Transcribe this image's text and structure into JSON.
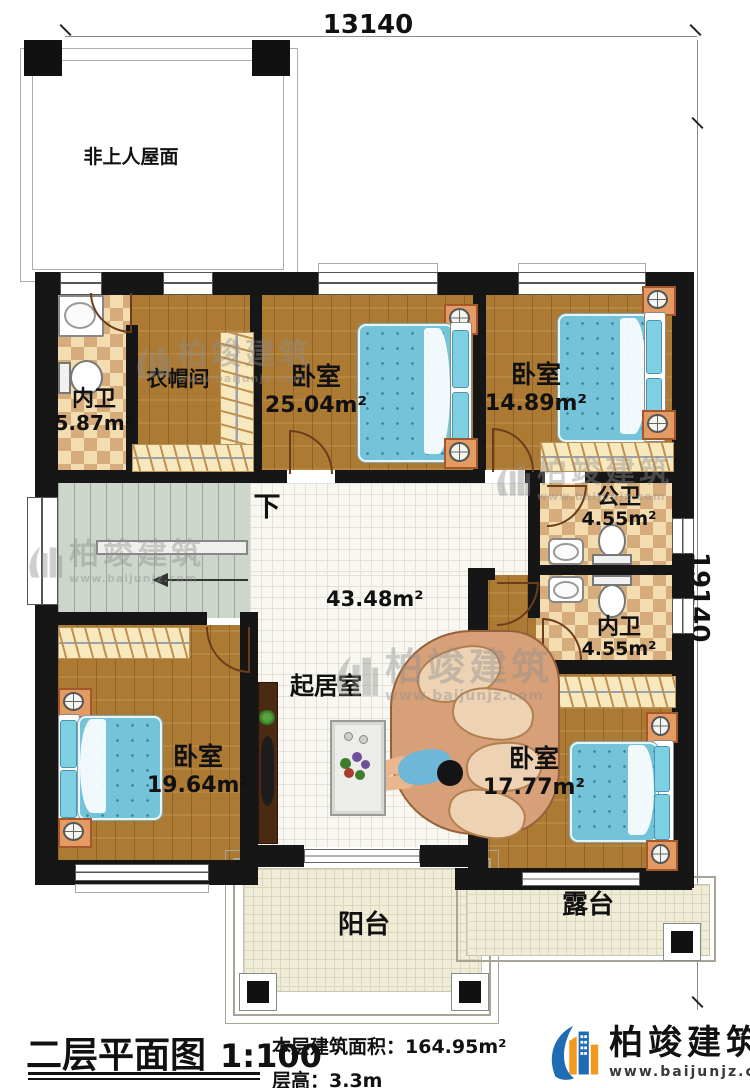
{
  "dimensions": {
    "top": "13140",
    "right": "19140"
  },
  "roof": {
    "label": "非上人屋面"
  },
  "stairs": {
    "down_label": "下"
  },
  "rooms": {
    "bath_top": {
      "name": "内卫",
      "area": "5.87m²"
    },
    "cloakroom": {
      "name": "衣帽间"
    },
    "bedroom_top_mid": {
      "name": "卧室",
      "area": "25.04m²"
    },
    "bedroom_top_right": {
      "name": "卧室",
      "area": "14.89m²"
    },
    "bath_public": {
      "name": "公卫",
      "area": "4.55m²"
    },
    "bath_ensuite": {
      "name": "内卫",
      "area": "4.55m²"
    },
    "living": {
      "name": "起居室",
      "area": "43.48m²"
    },
    "bedroom_bottom_left": {
      "name": "卧室",
      "area": "19.64m²"
    },
    "bedroom_bottom_right": {
      "name": "卧室",
      "area": "17.77m²"
    },
    "balcony": {
      "name": "阳台"
    },
    "terrace": {
      "name": "露台"
    }
  },
  "title_block": {
    "drawing_title": "二层平面图",
    "scale": "1:100",
    "area_label": "本层建筑面积：",
    "area_value": "164.95m²",
    "height_label": "层高：",
    "height_value": "3.3m"
  },
  "brand": {
    "name": "柏竣建筑",
    "website": "www.baijunjz.com"
  },
  "watermark": {
    "name": "柏竣建筑",
    "website": "www.baijunjz.com"
  },
  "colors": {
    "wall": "#161616",
    "wood": "#ad7a33",
    "tile": "#f2dcb0",
    "brand_blue": "#1e6db4",
    "brand_orange": "#f29a1e",
    "bed_blue": "#74c3d9"
  }
}
